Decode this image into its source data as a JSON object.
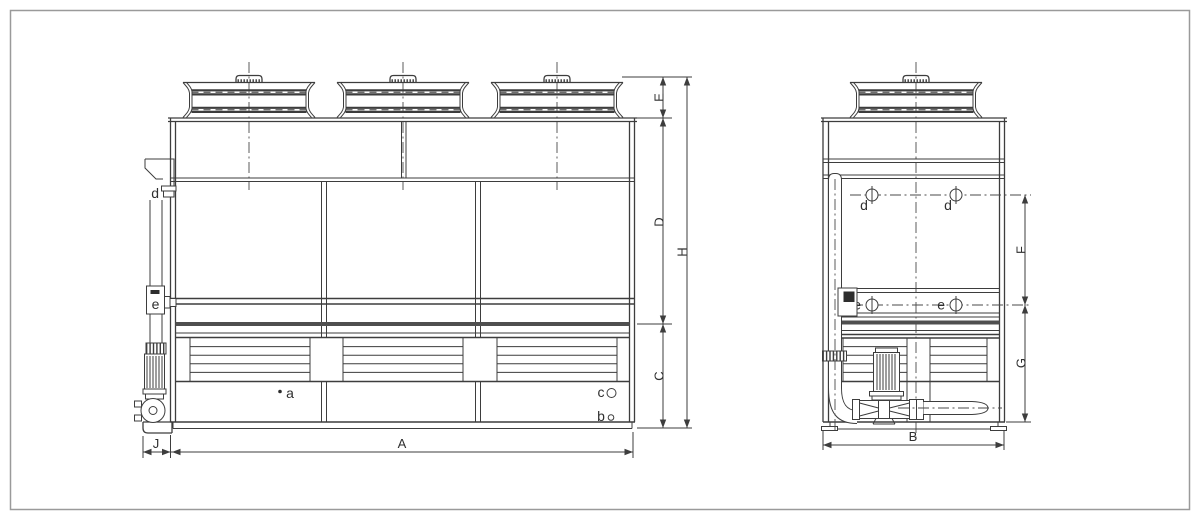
{
  "labels": {
    "dims": {
      "E": "E",
      "D": "D",
      "C": "C",
      "H": "H",
      "J": "J",
      "A": "A",
      "F": "F",
      "G": "G",
      "B": "B"
    },
    "ports": {
      "a": "a",
      "b": "b",
      "c": "c",
      "d": "d",
      "e": "e"
    }
  },
  "colors": {
    "line": "#3d3d3d",
    "dark_band": "#4f4f4f",
    "border": "#9a9a9a",
    "background": "#ffffff"
  }
}
